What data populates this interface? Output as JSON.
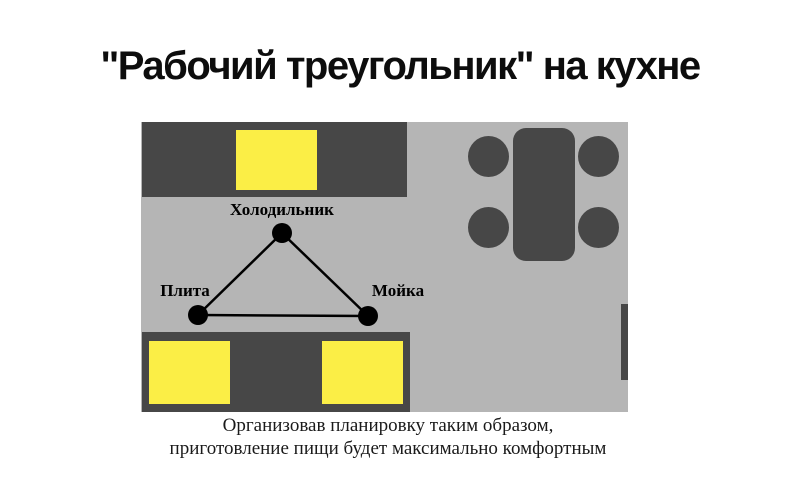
{
  "title": "\"Рабочий треугольник\" на кухне",
  "colors": {
    "counter_dark": "#474747",
    "floor_gray": "#b5b5b5",
    "appliance_yellow": "#fbee46",
    "line_black": "#000000"
  },
  "floor_plan": {
    "labels": {
      "fridge": "Холодильник",
      "stove": "Плита",
      "sink": "Мойка"
    }
  },
  "caption": {
    "line1": "Организовав планировку таким образом,",
    "line2": "приготовление пищи будет максимально комфортным"
  }
}
